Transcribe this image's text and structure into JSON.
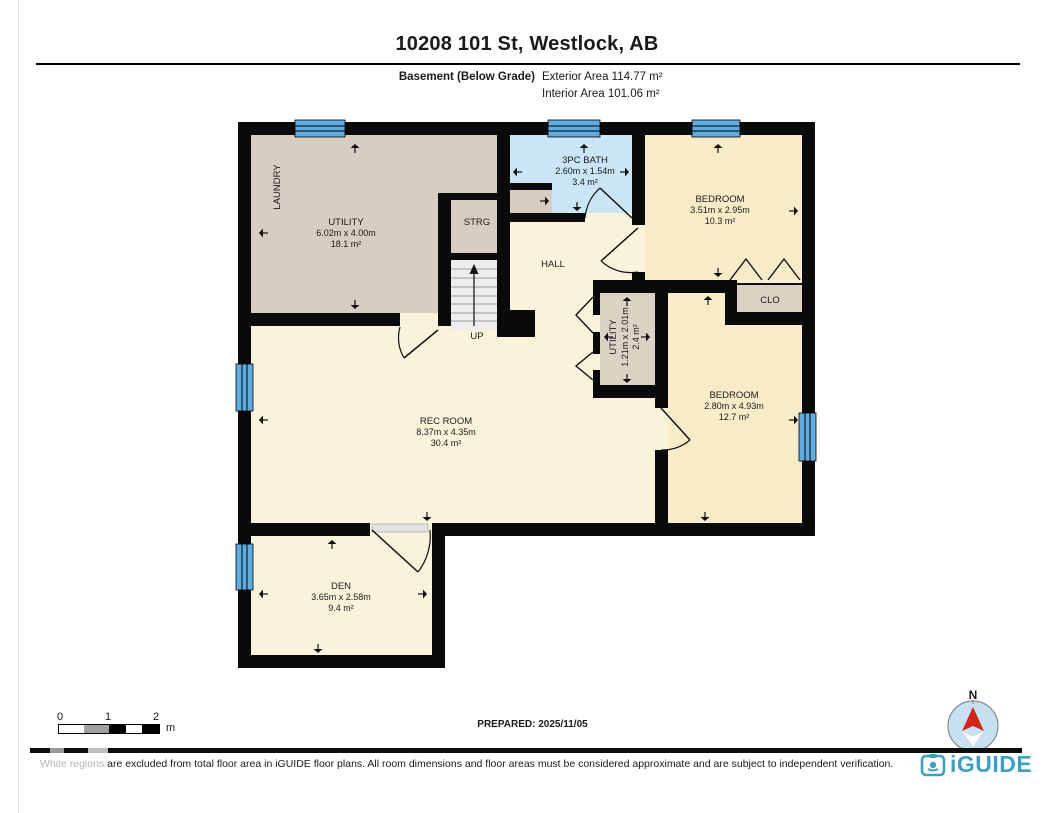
{
  "header": {
    "title": "10208 101 St, Westlock, AB",
    "floor_label": "Basement (Below Grade)",
    "exterior_area": "Exterior Area 114.77 m²",
    "interior_area": "Interior Area 101.06 m²"
  },
  "rooms": {
    "utility": {
      "name": "UTILITY",
      "dim": "6.02m x 4.00m",
      "area": "18.1 m²"
    },
    "laundry": {
      "name": "LAUNDRY"
    },
    "strg": {
      "name": "STRG"
    },
    "stairs": {
      "up_label": "UP"
    },
    "bath": {
      "name": "3PC BATH",
      "dim": "2.60m x 1.54m",
      "area": "3.4 m²"
    },
    "hall": {
      "name": "HALL"
    },
    "bedroom1": {
      "name": "BEDROOM",
      "dim": "3.51m x 2.95m",
      "area": "10.3 m²"
    },
    "clo": {
      "name": "CLO"
    },
    "utility2": {
      "name": "UTILITY",
      "dim": "1.21m x 2.01m",
      "area": "2.4 m²"
    },
    "bedroom2": {
      "name": "BEDROOM",
      "dim": "2.80m x 4.93m",
      "area": "12.7 m²"
    },
    "rec_room": {
      "name": "REC ROOM",
      "dim": "8.37m x 4.35m",
      "area": "30.4 m²"
    },
    "den": {
      "name": "DEN",
      "dim": "3.65m x 2.58m",
      "area": "9.4 m²"
    }
  },
  "footer": {
    "scale": {
      "tick0": "0",
      "tick1": "1",
      "tick2": "2",
      "unit": "m"
    },
    "prepared": "PREPARED: 2025/11/05",
    "disclaimer_highlight": "White regions",
    "disclaimer_rest": " are excluded from total floor area in iGUIDE floor plans. All room dimensions and floor areas must be considered approximate and are subject to independent verification.",
    "compass_north": "N",
    "brand": "iGUIDE"
  },
  "colors": {
    "wall": "#0a0a0a",
    "cream": "#faf3dc",
    "cream2": "#f8ebc8",
    "tan": "#d7cec1",
    "tan2": "#dbd2c4",
    "bath_blue": "#c9e5f6",
    "window_blue": "#5fade0",
    "stairs": "#ededed",
    "brand": "#3d9fc4",
    "north_red": "#d2251d",
    "compass_blue": "#c7e0f2"
  }
}
